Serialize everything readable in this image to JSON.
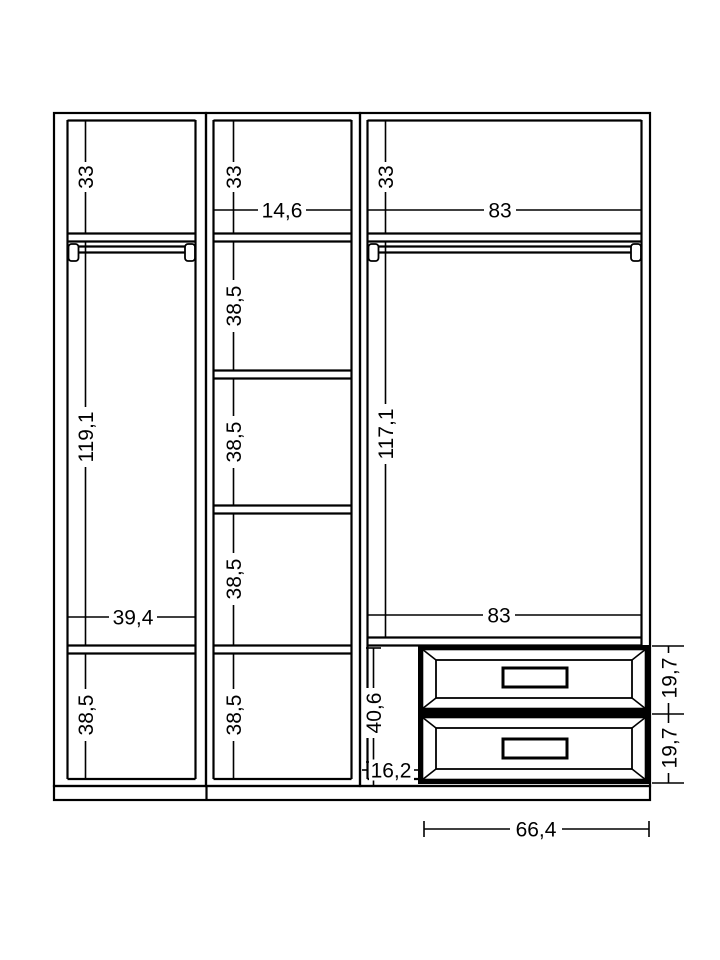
{
  "page": {
    "background": "#ffffff",
    "line_color": "#000000"
  },
  "dims": {
    "left": {
      "top": "33",
      "hang": "119,1",
      "width": "39,4",
      "bottom": "38,5"
    },
    "middle": {
      "top": "33",
      "width": "14,6",
      "sections": [
        "38,5",
        "38,5",
        "38,5",
        "38,5"
      ]
    },
    "right": {
      "top": "33",
      "width_top": "83",
      "hang": "117,1",
      "width_bottom": "83",
      "drawer_zone": "40,6",
      "base": "16,2",
      "drawers": [
        "19,7",
        "19,7"
      ],
      "drawer_width": "66,4"
    }
  }
}
